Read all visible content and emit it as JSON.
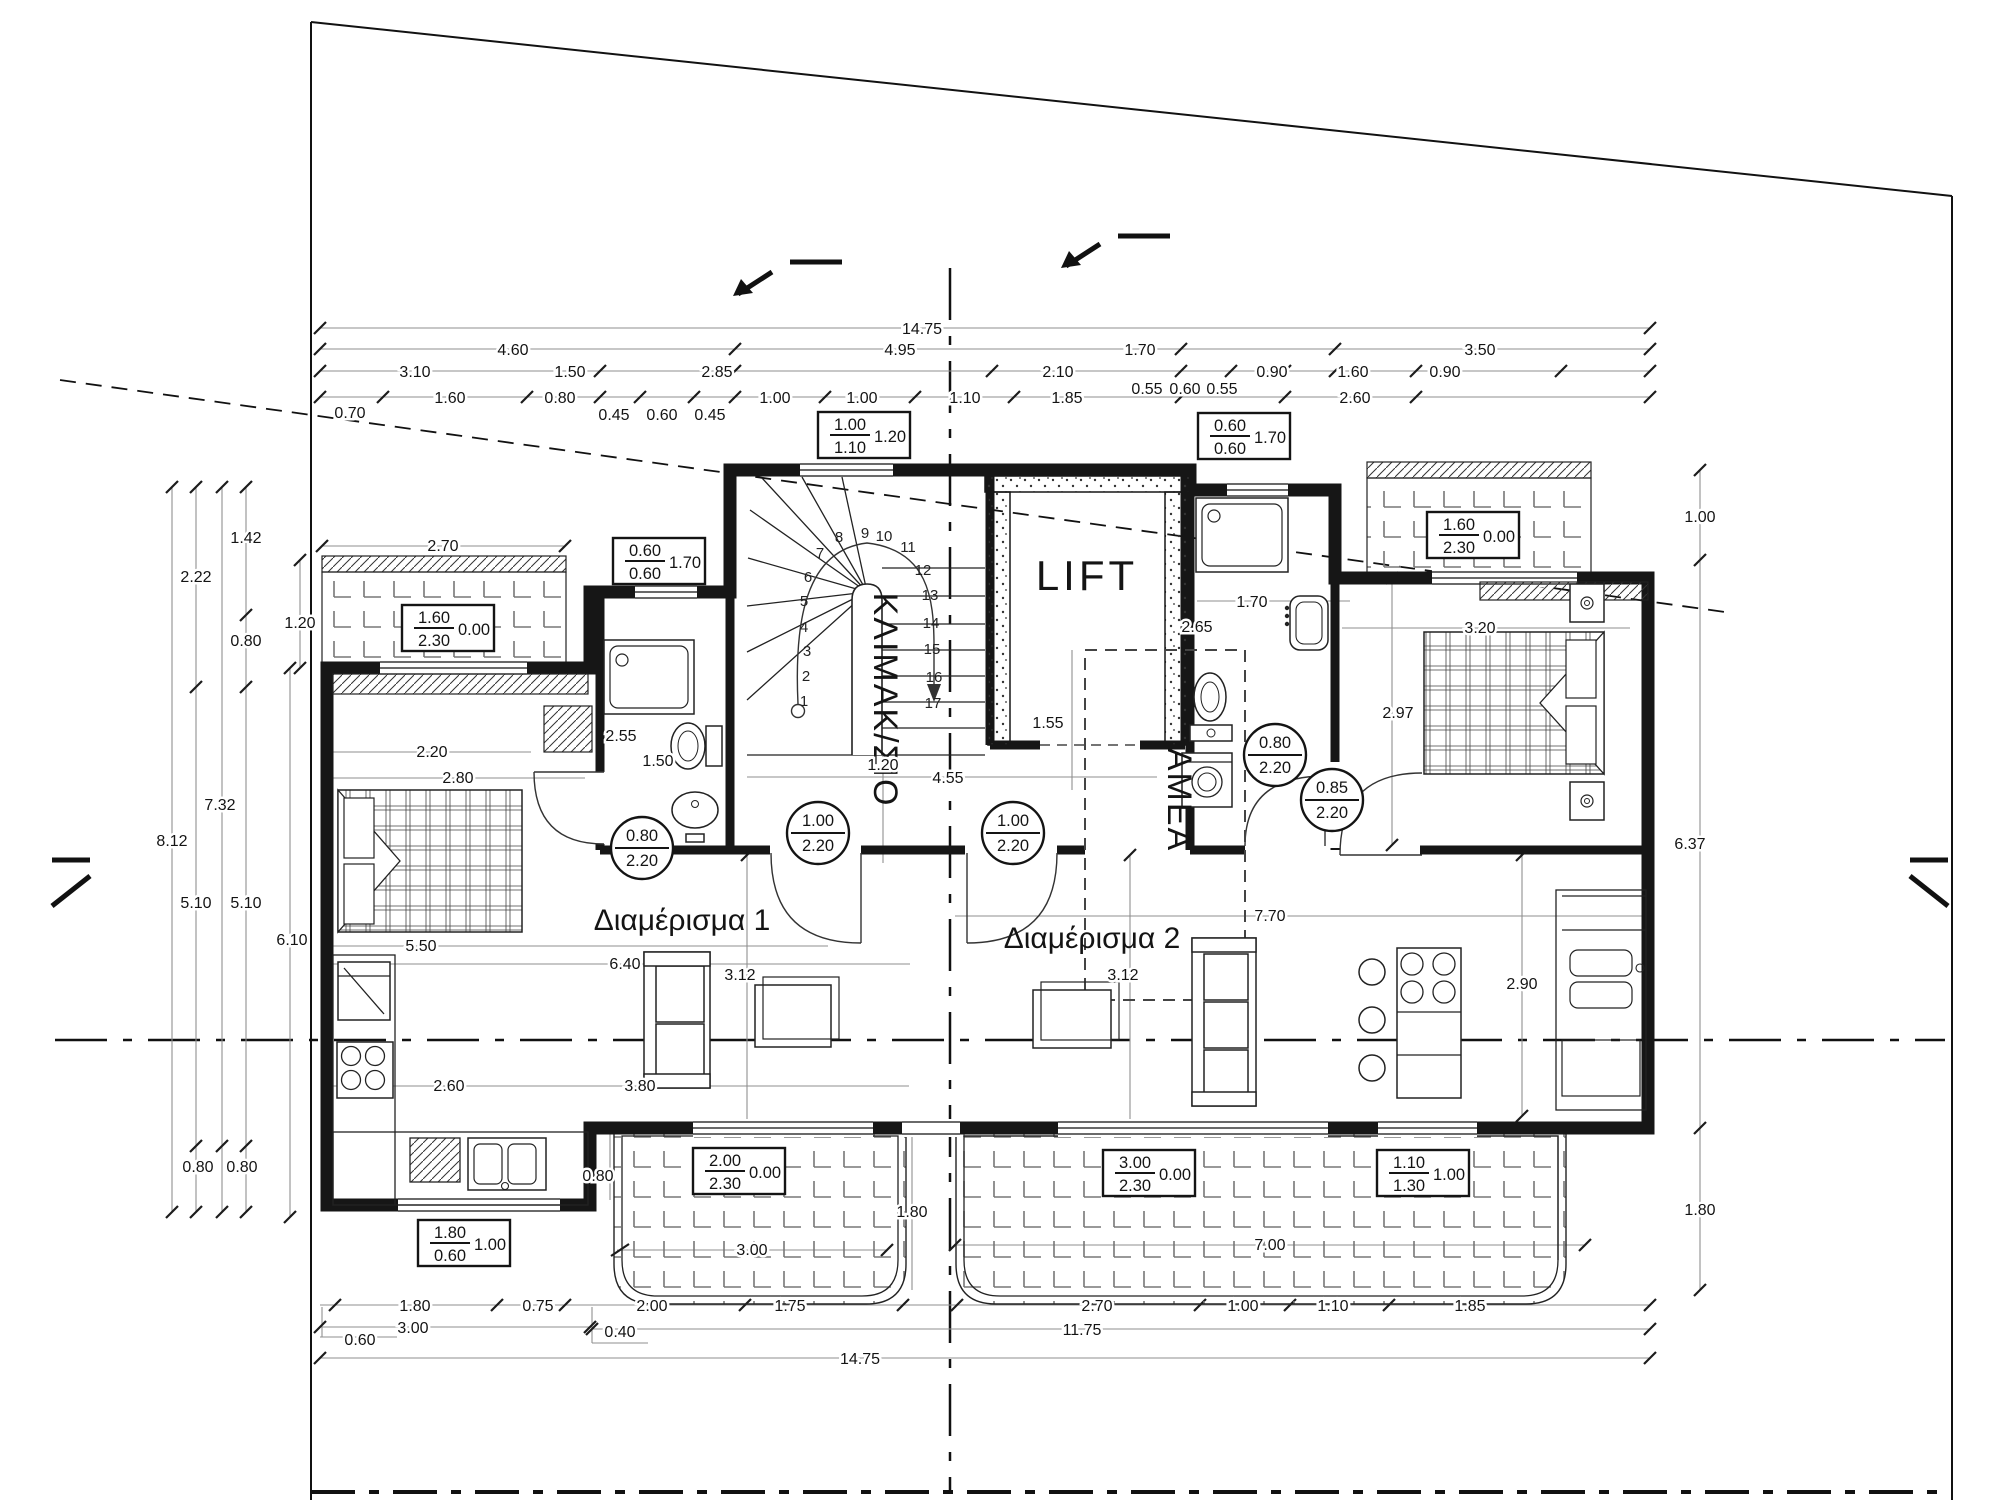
{
  "colors": {
    "ink": "#141414",
    "dim_line": "#8f8f8f",
    "wall": "#161616",
    "background": "#ffffff"
  },
  "labels": {
    "apartment1": "Διαμέρισμα 1",
    "apartment2": "Διαμέρισμα 2",
    "lift": "LIFT",
    "stairwell": "ΚΛΙΜΑΚ/ΣΙΟ",
    "amea": "ΑΜΕΑ"
  },
  "stairs": {
    "steps": [
      "1",
      "2",
      "3",
      "4",
      "5",
      "6",
      "7",
      "8",
      "9",
      "10",
      "11",
      "12",
      "13",
      "14",
      "15",
      "16",
      "17"
    ]
  },
  "callout_boxes": {
    "stair_top_window": {
      "top": "1.00",
      "bottom": "1.10",
      "side": "1.20"
    },
    "bath1_window": {
      "top": "0.60",
      "bottom": "0.60",
      "side": "1.70"
    },
    "bath2_window": {
      "top": "0.60",
      "bottom": "0.60",
      "side": "1.70"
    },
    "balcony1_top_door": {
      "top": "1.60",
      "bottom": "2.30",
      "side": "0.00"
    },
    "balcony2_top_door": {
      "top": "1.60",
      "bottom": "2.30",
      "side": "0.00"
    },
    "living1_balcony_door": {
      "top": "2.00",
      "bottom": "2.30",
      "side": "0.00"
    },
    "living2_balcony_door": {
      "top": "3.00",
      "bottom": "2.30",
      "side": "0.00"
    },
    "kitchen2_window": {
      "top": "1.10",
      "bottom": "1.30",
      "side": "1.00"
    },
    "kitchen1_window": {
      "top": "1.80",
      "bottom": "0.60",
      "side": "1.00"
    }
  },
  "door_tags": {
    "bath1": {
      "top": "0.80",
      "bottom": "2.20"
    },
    "apt1_entry": {
      "top": "1.00",
      "bottom": "2.20"
    },
    "apt2_entry": {
      "top": "1.00",
      "bottom": "2.20"
    },
    "bath2": {
      "top": "0.80",
      "bottom": "2.20"
    },
    "bedroom2": {
      "top": "0.85",
      "bottom": "2.20"
    }
  },
  "dims": {
    "top_row1": [
      "14.75"
    ],
    "top_row2": [
      "4.60",
      "4.95",
      "1.70",
      "3.50"
    ],
    "top_row3": [
      "3.10",
      "1.50",
      "2.85",
      "2.10",
      "0.55",
      "0.60",
      "0.55",
      "0.90",
      "1.60",
      "0.90"
    ],
    "top_row4": [
      "0.70",
      "1.60",
      "0.80",
      "0.45",
      "0.60",
      "0.45",
      "1.00",
      "1.00",
      "1.10",
      "1.85",
      "2.60"
    ],
    "left": [
      "1.42",
      "2.22",
      "0.80",
      "1.20",
      "7.32",
      "8.12",
      "5.10",
      "5.10",
      "6.10",
      "0.80",
      "0.80"
    ],
    "right": [
      "1.00",
      "6.37",
      "1.80"
    ],
    "bottom_row1": [
      "1.80",
      "0.75",
      "2.00",
      "1.75",
      "2.70",
      "1.00",
      "1.10",
      "1.85"
    ],
    "bottom_row2": [
      "3.00",
      "0.40",
      "11.75"
    ],
    "bottom_row3": [
      "0.60"
    ],
    "bottom_row4": [
      "14.75"
    ],
    "interior": [
      "2.70",
      "2.20",
      "2.80",
      "5.50",
      "2.60",
      "6.40",
      "3.80",
      "3.12",
      "2.55",
      "1.50",
      "1.20",
      "4.55",
      "1.55",
      "2.65",
      "1.70",
      "2.97",
      "3.20",
      "7.70",
      "2.90",
      "3.12",
      "1.80",
      "3.00",
      "7.00",
      "0.80"
    ]
  }
}
